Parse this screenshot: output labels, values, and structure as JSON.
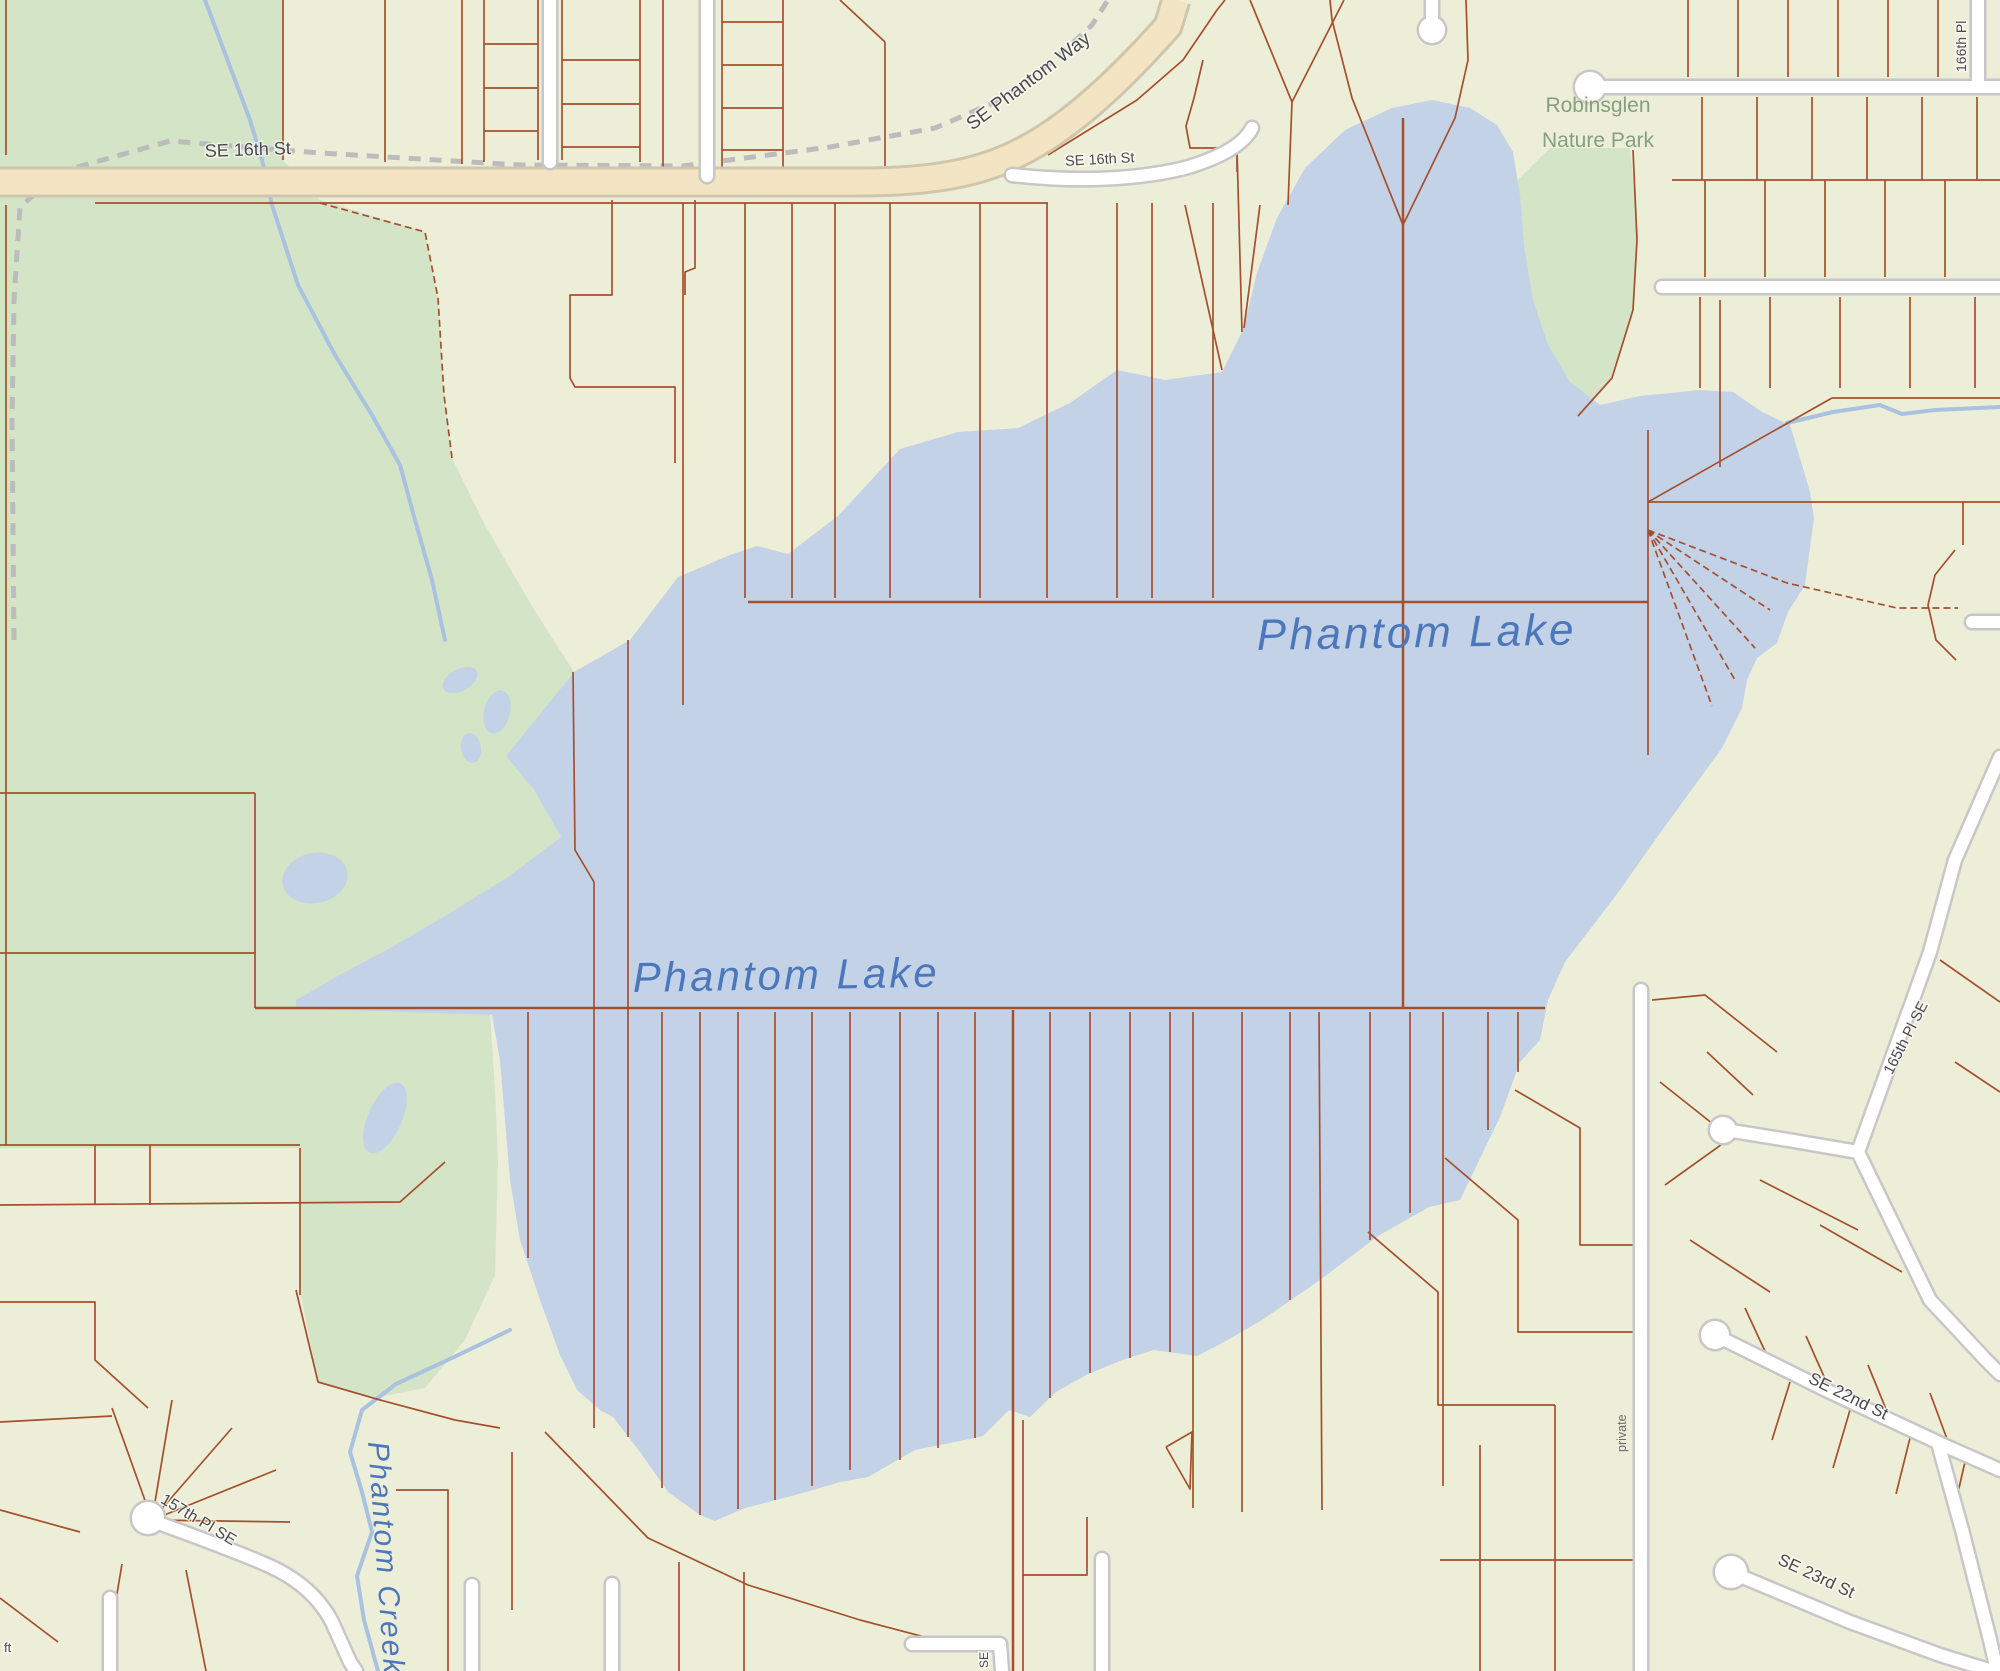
{
  "map": {
    "region_name": "Phantom Lake",
    "colors": {
      "land": "#edeed8",
      "park_green": "#d4e4c6",
      "water_blue": "#c3d2e7",
      "creek_blue": "#a9c2e0",
      "parcel_red": "#a5502d",
      "road_tan_fill": "#f3e5c3",
      "road_tan_casing": "#cfc6ab",
      "road_white_fill": "#ffffff",
      "road_white_casing": "#c7c7c7",
      "trail_gray": "#bcbcbc",
      "street_label": "#4a4a4a",
      "park_label": "#84a07e",
      "water_label": "#4c78bb"
    },
    "labels": [
      {
        "name": "label-se-16th-st-west",
        "text": "SE 16th St",
        "x": 205,
        "y": 157,
        "rot": -2,
        "size": 18,
        "cls": "lbl-street",
        "anchor": "start"
      },
      {
        "name": "label-se-phantom-way",
        "text": "SE Phantom Way",
        "x": 1032,
        "y": 86,
        "rot": -37,
        "size": 19,
        "cls": "lbl-street",
        "anchor": "middle"
      },
      {
        "name": "label-se-16th-st-east",
        "text": "SE 16th St",
        "x": 1100,
        "y": 164,
        "rot": -3,
        "size": 14.5,
        "cls": "lbl-street",
        "anchor": "middle"
      },
      {
        "name": "label-robinsglen-line1",
        "text": "Robinsglen",
        "x": 1598,
        "y": 112,
        "rot": 0,
        "size": 21,
        "cls": "lbl-park",
        "anchor": "middle"
      },
      {
        "name": "label-robinsglen-line2",
        "text": "Nature Park",
        "x": 1598,
        "y": 147,
        "rot": 0,
        "size": 21,
        "cls": "lbl-park",
        "anchor": "middle"
      },
      {
        "name": "label-phantom-lake-west",
        "text": "Phantom Lake",
        "x": 633,
        "y": 992,
        "rot": -1,
        "size": 42,
        "cls": "lbl-water",
        "anchor": "start",
        "ls": 3
      },
      {
        "name": "label-phantom-lake-east",
        "text": "Phantom Lake",
        "x": 1257,
        "y": 650,
        "rot": -1,
        "size": 44,
        "cls": "lbl-water",
        "anchor": "start",
        "ls": 3
      },
      {
        "name": "label-phantom-creek",
        "text": "Phantom Creek",
        "x": 368,
        "y": 1442,
        "rot": 86,
        "size": 30,
        "cls": "lbl-water",
        "anchor": "start",
        "ls": 2
      },
      {
        "name": "label-157th-pl-se",
        "text": "157th Pl SE",
        "x": 196,
        "y": 1524,
        "rot": 31,
        "size": 16,
        "cls": "lbl-street",
        "anchor": "middle"
      },
      {
        "name": "label-se-22nd-st",
        "text": "SE 22nd St",
        "x": 1846,
        "y": 1401,
        "rot": 26,
        "size": 17,
        "cls": "lbl-street",
        "anchor": "middle"
      },
      {
        "name": "label-se-23rd-st",
        "text": "SE 23rd St",
        "x": 1814,
        "y": 1581,
        "rot": 25,
        "size": 17,
        "cls": "lbl-street",
        "anchor": "middle"
      },
      {
        "name": "label-165th-pl-se",
        "text": "165th Pl SE",
        "x": 1910,
        "y": 1040,
        "rot": -63,
        "size": 15,
        "cls": "lbl-street",
        "anchor": "middle"
      },
      {
        "name": "label-166th-pl",
        "text": "166th Pl",
        "x": 1966,
        "y": 72,
        "rot": -90,
        "size": 14,
        "cls": "lbl-street",
        "anchor": "start"
      },
      {
        "name": "label-private",
        "text": "private",
        "x": 1626,
        "y": 1452,
        "rot": -90,
        "size": 12.5,
        "cls": "lbl-street-plain",
        "anchor": "start"
      },
      {
        "name": "label-se-partial",
        "text": "SE",
        "x": 988,
        "y": 1668,
        "rot": -90,
        "size": 12,
        "cls": "lbl-street",
        "anchor": "start"
      },
      {
        "name": "label-ft-partial",
        "text": "ft",
        "x": 4,
        "y": 1652,
        "rot": 0,
        "size": 13,
        "cls": "lbl-street",
        "anchor": "start"
      }
    ],
    "water": {
      "lake_name": "Phantom Lake",
      "lake_points": "574,672 630,640 678,577 730,555 757,546 788,554 838,516 900,449 958,432 1018,428 1070,403 1117,370 1165,380 1222,372 1243,330 1257,273 1277,218 1305,168 1345,130 1392,108 1432,100 1470,108 1497,125 1513,152 1520,195 1524,245 1533,300 1548,345 1570,382 1600,405 1640,396 1700,390 1733,392 1762,412 1790,425 1800,458 1810,492 1814,518 1805,585 1788,612 1777,643 1757,658 1747,680 1742,708 1722,748 1690,792 1655,840 1620,890 1588,932 1565,962 1548,1000 1540,1040 1520,1062 1500,1117 1460,1200 1429,1207 1378,1236 1320,1280 1262,1320 1226,1341 1197,1356 1154,1350 1125,1359 1088,1374 1056,1392 1030,1417 1009,1410 983,1436 955,1442 915,1450 868,1477 840,1482 792,1496 745,1508 715,1521 700,1515 668,1492 640,1452 613,1417 600,1410 577,1390 560,1355 540,1300 520,1240 510,1180 505,1120 500,1060 492,1015 296,1008 296,1000 341,974 392,947 443,917 508,877 561,837 534,790 506,756",
      "ponds": [
        {
          "cx": 460,
          "cy": 680,
          "rx": 19,
          "ry": 11,
          "rot": -28
        },
        {
          "cx": 497,
          "cy": 712,
          "rx": 13,
          "ry": 22,
          "rot": 14
        },
        {
          "cx": 471,
          "cy": 748,
          "rx": 10,
          "ry": 15,
          "rot": -8
        },
        {
          "cx": 385,
          "cy": 1118,
          "rx": 17,
          "ry": 38,
          "rot": 24
        },
        {
          "cx": 315,
          "cy": 878,
          "rx": 33,
          "ry": 25,
          "rot": -12
        }
      ],
      "creeks": [
        {
          "name": "phantom-creek-north",
          "pts": "205,0 250,120 262,160 272,205 298,285 335,355 372,415 400,465 415,520 432,580 445,640"
        },
        {
          "name": "phantom-creek-south",
          "pts": "510,1330 452,1358 396,1384 362,1410 350,1452 362,1492 372,1532 357,1576 364,1620 378,1671"
        },
        {
          "name": "lake-outlet-east",
          "pts": "1787,423 1833,412 1880,405 1902,414 1935,410 2000,407"
        }
      ]
    },
    "parks": [
      {
        "name": "west-park",
        "points": "0,0 283,0 283,160 320,200 425,232 438,298 444,395 452,458 485,525 533,608 574,672 506,756 534,790 561,837 508,877 443,917 392,947 341,974 296,1000 296,1008 490,1012 495,1090 498,1160 495,1275 465,1340 425,1388 375,1398 318,1382 300,1290 300,1148 0,1148"
      },
      {
        "name": "robinsglen-nature-park",
        "points": "1518,180 1550,148 1630,148 1638,235 1632,315 1610,382 1575,420 1545,405 1525,340 1515,250"
      }
    ],
    "trail": "14,640 12,420 14,300 20,207 60,172 170,141 320,153 520,165 683,166 830,147 935,128 1000,100 1052,62 1092,25 1108,0",
    "roads": {
      "tan": [
        {
          "name": "se-16th-st-arterial",
          "d": "M0,182 L860,182 C955,182 1000,166 1042,140 C1090,110 1138,60 1168,26 L1176,0"
        }
      ],
      "white": [
        {
          "name": "se-16th-st-loop",
          "d": "M1012,175 Q1110,186 1185,168 Q1240,152 1252,128"
        },
        {
          "name": "road-550",
          "d": "M550,0 L550,162"
        },
        {
          "name": "road-707",
          "d": "M707,0 L707,176"
        },
        {
          "name": "cul-de-sac-stub-top",
          "d": "M1432,0 L1432,24"
        },
        {
          "name": "road-ne-1",
          "d": "M1584,87 L2000,87"
        },
        {
          "name": "road-ne-2",
          "d": "M1662,287 L2000,287"
        },
        {
          "name": "road-166th",
          "d": "M1978,0 L1978,80"
        },
        {
          "name": "road-east-nub",
          "d": "M1972,622 L2000,622"
        },
        {
          "name": "road-private",
          "d": "M1641,990 L1641,1671"
        },
        {
          "name": "road-165th-a",
          "d": "M2000,757 L1955,860 L1930,952 L1858,1152"
        },
        {
          "name": "road-165th-b",
          "d": "M1858,1152 L1930,1300 L1986,1360 L2000,1374"
        },
        {
          "name": "road-165th-branch",
          "d": "M1858,1152 L1788,1140 L1726,1130"
        },
        {
          "name": "road-se-22nd",
          "d": "M1717,1336 L1830,1392 L1950,1448 L2000,1470"
        },
        {
          "name": "road-se-22nd-corner",
          "d": "M1938,1443 L1962,1530 L1990,1640 L1997,1671"
        },
        {
          "name": "road-se-23rd",
          "d": "M1733,1573 L1850,1622 L1940,1655 L1992,1671"
        },
        {
          "name": "road-157th-pl",
          "d": "M150,1520 Q225,1547 265,1564 Q312,1584 332,1622 L350,1662 L356,1671"
        },
        {
          "name": "stub-110",
          "d": "M110,1598 L110,1671"
        },
        {
          "name": "stub-472",
          "d": "M472,1585 L472,1671"
        },
        {
          "name": "stub-612",
          "d": "M612,1584 L612,1671"
        },
        {
          "name": "road-l-bottom",
          "d": "M912,1644 L1000,1644 L1002,1671"
        },
        {
          "name": "stub-1102",
          "d": "M1102,1559 L1102,1671"
        }
      ],
      "bulbs": [
        {
          "name": "bulb-top-stub",
          "cx": 1432,
          "cy": 30,
          "r": 13
        },
        {
          "name": "bulb-ne-road",
          "cx": 1590,
          "cy": 87,
          "r": 15
        },
        {
          "name": "bulb-165th-branch",
          "cx": 1723,
          "cy": 1130,
          "r": 13
        },
        {
          "name": "bulb-se-22nd",
          "cx": 1715,
          "cy": 1335,
          "r": 14
        },
        {
          "name": "bulb-se-23rd",
          "cx": 1731,
          "cy": 1572,
          "r": 16
        },
        {
          "name": "bulb-157th",
          "cx": 148,
          "cy": 1518,
          "r": 16
        }
      ]
    },
    "parcels": {
      "major": [
        "255,1008 1545,1008",
        "748,602 1648,602",
        "1403,118 1403,1008",
        "1013,1010 1013,1671"
      ],
      "dashed": [
        "320,203 425,232 438,298 444,395 452,458",
        "1648,530 1787,583 1897,608 1958,608",
        "1648,530 1770,610",
        "1648,530 1755,648",
        "1648,530 1735,680",
        "1648,530 1712,706"
      ],
      "minor": [
        "6,0 6,155",
        "283,0 283,160",
        "385,0 385,162",
        "462,0 462,164",
        "484,0 484,162",
        "538,0 538,160",
        "484,44 538,44",
        "484,88 538,88",
        "484,131 538,131",
        "562,0 562,160",
        "640,0 640,162",
        "562,60 640,60",
        "562,104 640,104",
        "562,147 640,147",
        "663,0 663,168",
        "722,0 722,170",
        "783,0 783,170",
        "722,22 783,22",
        "722,65 783,65",
        "722,108 783,108",
        "722,150 783,150",
        "840,0 885,42",
        "885,42 885,166",
        "95,203 1048,203",
        "6,205 6,1145",
        "0,793 255,793",
        "0,953 255,953",
        "255,793 255,1008",
        "0,1145 300,1145",
        "0,1205 400,1202 445,1162",
        "95,1145 95,1205",
        "150,1145 150,1205",
        "300,1148 300,1295",
        "296,1290 318,1382 380,1400 455,1420 500,1428",
        "612,200 612,295 570,295 570,378 575,387 675,387 675,463",
        "695,200 695,268 685,272 685,295",
        "1048,155 1137,100 1183,60 1217,10 1225,0",
        "1203,60 1194,98 1186,126 1190,148 1237,148 1237,172",
        "683,203 683,705",
        "745,203 745,598",
        "792,203 792,598",
        "835,203 835,598",
        "890,203 890,598",
        "980,203 980,598",
        "1047,203 1047,598",
        "1117,203 1117,598",
        "1152,203 1152,598",
        "1213,203 1213,598",
        "1185,205 1222,370",
        "1260,205 1244,328",
        "1237,150 1242,332",
        "1292,102 1250,0",
        "1292,102 1344,0",
        "1292,102 1288,205",
        "1403,225 1352,98 1332,20 1330,0",
        "1403,225 1455,118 1468,60 1466,0",
        "1688,0 1688,77",
        "1738,0 1738,77",
        "1788,0 1788,77",
        "1838,0 1838,77",
        "1888,0 1888,77",
        "1938,0 1938,77",
        "1672,180 2000,180",
        "1702,97 1702,180",
        "1757,97 1757,180",
        "1812,97 1812,180",
        "1867,97 1867,180",
        "1922,97 1922,180",
        "1977,97 1977,180",
        "1705,180 1705,277",
        "1765,180 1765,277",
        "1825,180 1825,277",
        "1885,180 1885,277",
        "1945,180 1945,277",
        "1700,297 1700,388",
        "1770,297 1770,388",
        "1840,297 1840,388",
        "1910,297 1910,388",
        "1975,297 1975,388",
        "1720,300 1720,467",
        "1832,398 2000,398",
        "1648,502 1832,398",
        "1648,502 2000,502",
        "1963,502 1963,545",
        "1955,550 1935,575 1928,605 1936,640 1956,660",
        "1633,150 1637,240 1633,310 1612,378 1578,416",
        "1648,430 1648,755",
        "528,1012 528,1258",
        "573,672 575,850 594,882 594,1428",
        "628,640 628,1437",
        "662,1012 662,1488",
        "700,1012 700,1515",
        "738,1012 738,1509",
        "775,1012 775,1500",
        "812,1012 812,1486",
        "850,1012 850,1470",
        "900,1012 900,1460",
        "938,1012 938,1448",
        "975,1012 975,1438",
        "1023,1420 1023,1671",
        "1050,1012 1050,1398",
        "1090,1012 1090,1373",
        "1130,1012 1130,1358",
        "1170,1012 1170,1352",
        "1193,1012 1193,1508",
        "1242,1012 1242,1512",
        "1290,1012 1290,1300",
        "1319,1012 1322,1510",
        "1370,1012 1370,1240",
        "1410,1012 1410,1213",
        "1443,1012 1443,1486",
        "1488,1012 1488,1130",
        "1518,1012 1518,1072",
        "1166,1447 1192,1432 1190,1489 1166,1447",
        "545,1432 648,1538 748,1585 860,1620 955,1645",
        "679,1562 679,1671",
        "744,1572 744,1671",
        "1022,1575 1087,1575 1087,1517",
        "396,1490 448,1490 448,1671",
        "512,1452 512,1610",
        "1515,1090 1580,1128 1580,1245 1638,1245",
        "1445,1158 1518,1220 1518,1332 1638,1332",
        "1368,1232 1438,1292 1438,1405 1555,1405",
        "1555,1405 1555,1671",
        "1480,1445 1480,1671",
        "1440,1560 1638,1560",
        "1652,1000 1705,995 1777,1052",
        "1707,1052 1753,1095",
        "1660,1082 1718,1128",
        "1665,1185 1725,1142",
        "1940,960 2000,1002",
        "1955,1062 2000,1092",
        "1760,1180 1858,1230",
        "1820,1225 1902,1272",
        "1770,1362 1745,1308",
        "1830,1390 1806,1336",
        "1890,1419 1868,1365",
        "1950,1447 1930,1393",
        "1790,1382 1772,1440",
        "1850,1410 1833,1468",
        "1910,1438 1896,1494",
        "1965,1462 1953,1514",
        "1690,1240 1770,1292",
        "152,1520 112,1408",
        "152,1520 172,1400",
        "152,1520 232,1428",
        "152,1520 276,1470",
        "152,1520 290,1522",
        "0,1302 95,1302 95,1360 148,1408",
        "0,1422 112,1416",
        "122,1564 104,1671",
        "186,1570 206,1671",
        "0,1510 80,1532",
        "0,1598 58,1642"
      ]
    }
  }
}
